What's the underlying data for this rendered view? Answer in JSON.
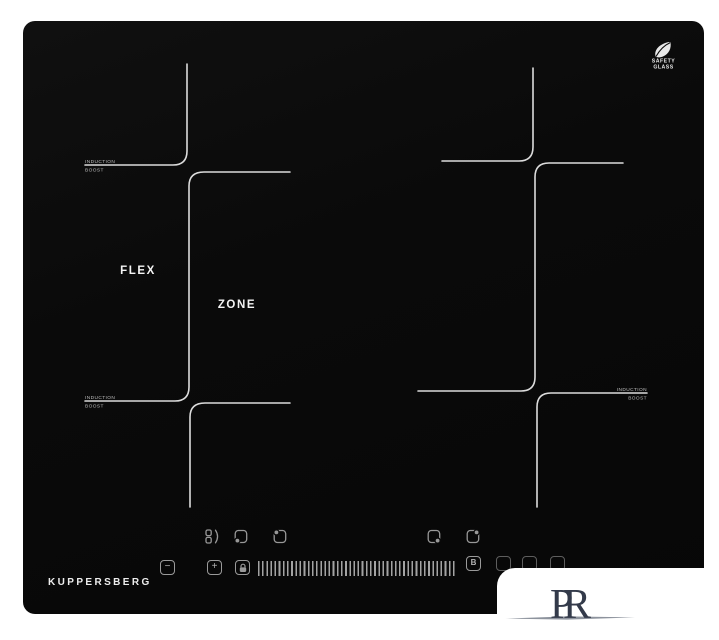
{
  "cooktop": {
    "surface_color": "#0a0a0a",
    "line_color": "#dcdcdc",
    "brand": "KUPPERSBERG",
    "flex_label": {
      "line1": "FLEX",
      "line2": "ZONE"
    },
    "safety_badge": {
      "line1": "SAFETY",
      "line2": "GLASS",
      "icon": "leaf-icon"
    },
    "zone_labels": [
      {
        "id": "left-top",
        "line1": "INDUCTION",
        "line2": "BOOST"
      },
      {
        "id": "left-bottom",
        "line1": "INDUCTION",
        "line2": "BOOST"
      },
      {
        "id": "right-bottom",
        "line1": "INDUCTION",
        "line2": "BOOST"
      }
    ],
    "controls": {
      "accent_color": "#9a9a9a",
      "zone_select_icons": [
        {
          "name": "flex-bridge-zone-icon"
        },
        {
          "name": "front-left-zone-icon"
        },
        {
          "name": "rear-left-zone-icon"
        },
        {
          "name": "front-right-zone-icon"
        },
        {
          "name": "rear-right-zone-icon"
        }
      ],
      "minus_label": "−",
      "plus_label": "+",
      "lock_icon": "lock-icon",
      "boost_label": "B",
      "slider_name": "power-slider"
    }
  },
  "watermark": {
    "monogram_p": "P",
    "monogram_r": "R",
    "color": "#333a4a"
  }
}
